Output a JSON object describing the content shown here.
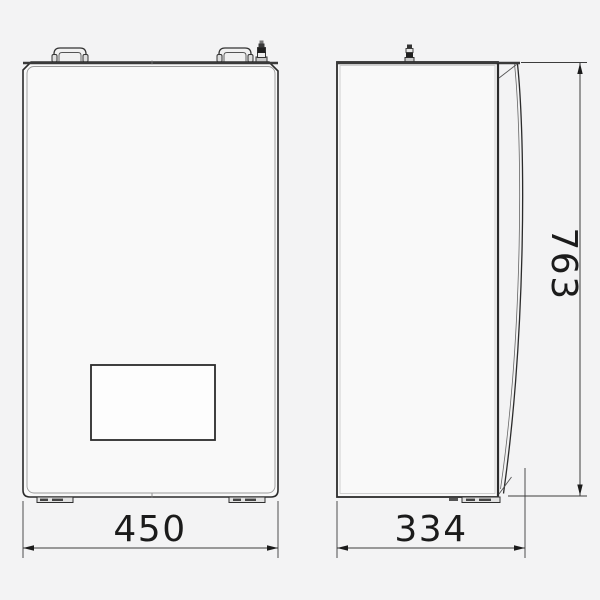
{
  "drawing": {
    "type": "technical-dimension-drawing",
    "dimensions": {
      "width_front": {
        "label": "450"
      },
      "depth_side": {
        "label": "334"
      },
      "height": {
        "label": "763"
      }
    },
    "colors": {
      "background": "#f3f3f4",
      "outline": "#2b2b2b",
      "panel_fill": "#f9f9f9",
      "inner_line": "#999999",
      "dimension_line": "#3c3c3c",
      "label_text": "#1b1b1b"
    }
  }
}
